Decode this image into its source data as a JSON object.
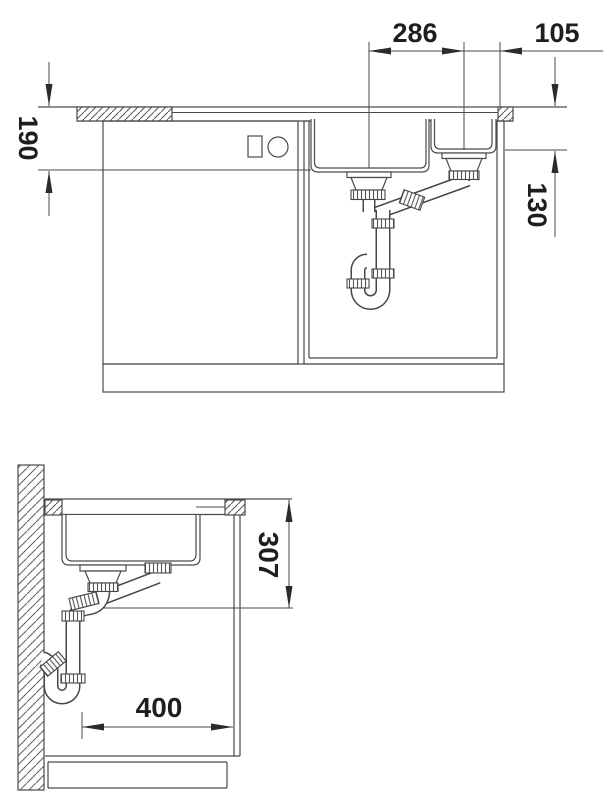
{
  "drawing": {
    "kind": "sink installation diagram",
    "colors": {
      "line": "#4a4a4a",
      "text": "#1e1e1e",
      "background": "#ffffff"
    },
    "views": {
      "front": {
        "dims": {
          "bowl_spacing": "286",
          "right_edge_offset": "105",
          "main_bowl_depth": "190",
          "small_bowl_depth": "130"
        }
      },
      "side": {
        "dims": {
          "fitting_depth": "307",
          "clearance_width": "400"
        }
      }
    }
  }
}
